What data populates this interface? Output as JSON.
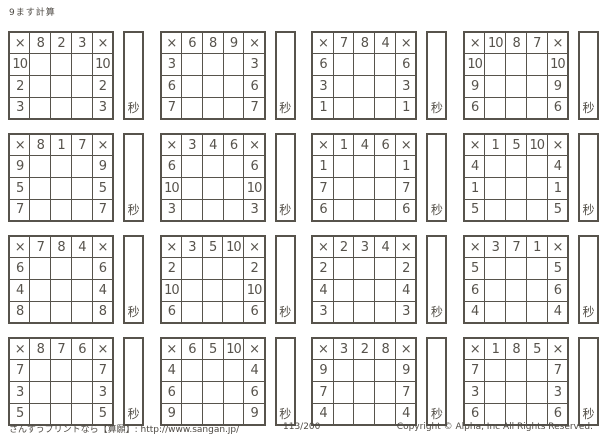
{
  "title": "9ます計算",
  "multiply_sign": "×",
  "seconds_label": "秒",
  "grids": [
    {
      "top": [
        "8",
        "2",
        "3"
      ],
      "rows": [
        "10",
        "2",
        "3"
      ]
    },
    {
      "top": [
        "6",
        "8",
        "9"
      ],
      "rows": [
        "3",
        "6",
        "7"
      ]
    },
    {
      "top": [
        "7",
        "8",
        "4"
      ],
      "rows": [
        "6",
        "3",
        "1"
      ]
    },
    {
      "top": [
        "10",
        "8",
        "7"
      ],
      "rows": [
        "10",
        "9",
        "6"
      ]
    },
    {
      "top": [
        "8",
        "1",
        "7"
      ],
      "rows": [
        "9",
        "5",
        "7"
      ]
    },
    {
      "top": [
        "3",
        "4",
        "6"
      ],
      "rows": [
        "6",
        "10",
        "3"
      ]
    },
    {
      "top": [
        "1",
        "4",
        "6"
      ],
      "rows": [
        "1",
        "7",
        "6"
      ]
    },
    {
      "top": [
        "1",
        "5",
        "10"
      ],
      "rows": [
        "4",
        "1",
        "5"
      ]
    },
    {
      "top": [
        "7",
        "8",
        "4"
      ],
      "rows": [
        "6",
        "4",
        "8"
      ]
    },
    {
      "top": [
        "3",
        "5",
        "10"
      ],
      "rows": [
        "2",
        "10",
        "6"
      ]
    },
    {
      "top": [
        "2",
        "3",
        "4"
      ],
      "rows": [
        "2",
        "4",
        "3"
      ]
    },
    {
      "top": [
        "3",
        "7",
        "1"
      ],
      "rows": [
        "5",
        "6",
        "4"
      ]
    },
    {
      "top": [
        "8",
        "7",
        "6"
      ],
      "rows": [
        "7",
        "3",
        "5"
      ]
    },
    {
      "top": [
        "6",
        "5",
        "10"
      ],
      "rows": [
        "4",
        "6",
        "9"
      ]
    },
    {
      "top": [
        "3",
        "2",
        "8"
      ],
      "rows": [
        "9",
        "7",
        "4"
      ]
    },
    {
      "top": [
        "1",
        "8",
        "5"
      ],
      "rows": [
        "7",
        "3",
        "6"
      ]
    }
  ],
  "footer": {
    "left": "さんすうプリントなら【算願】: http://www.sangan.jp/",
    "page": "113/200",
    "right": "Copyright © Alpha, Inc All Rights Reserved."
  }
}
